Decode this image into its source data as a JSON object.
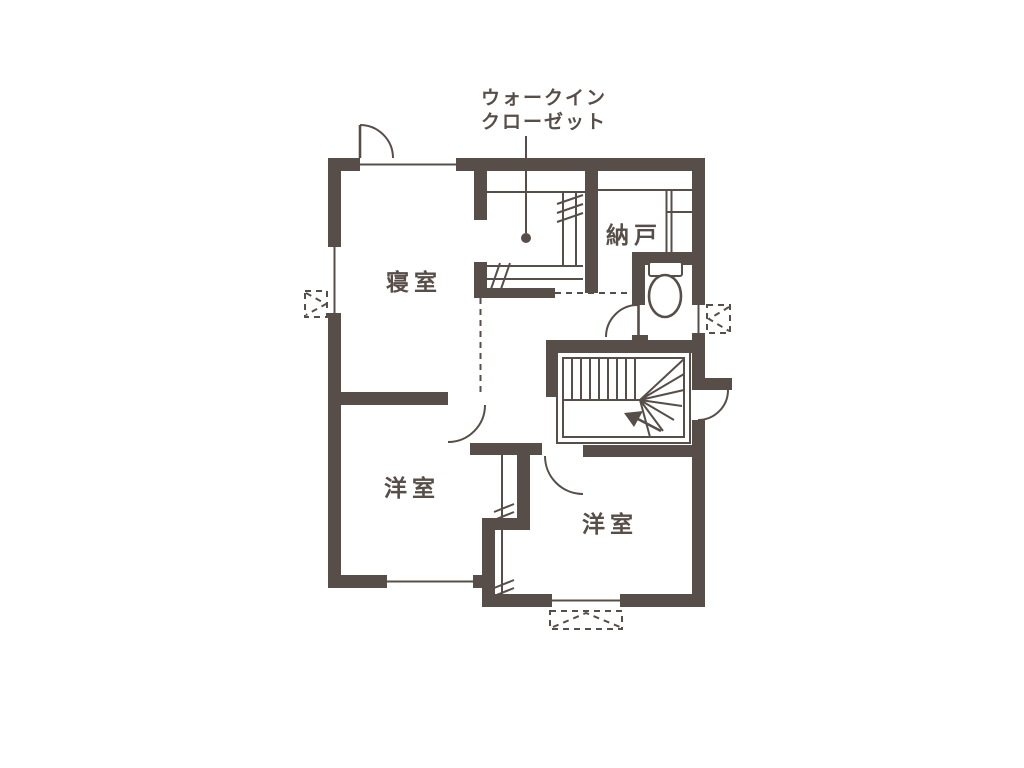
{
  "colors": {
    "wall": "#584e49",
    "background": "#ffffff"
  },
  "floor_plan": {
    "walk_in_closet_label": {
      "line1": "ウォークイン",
      "line2": "クローゼット"
    },
    "rooms": {
      "bedroom": "寝室",
      "storage": "納戸",
      "western_room_left": "洋室",
      "western_room_right": "洋室"
    }
  }
}
